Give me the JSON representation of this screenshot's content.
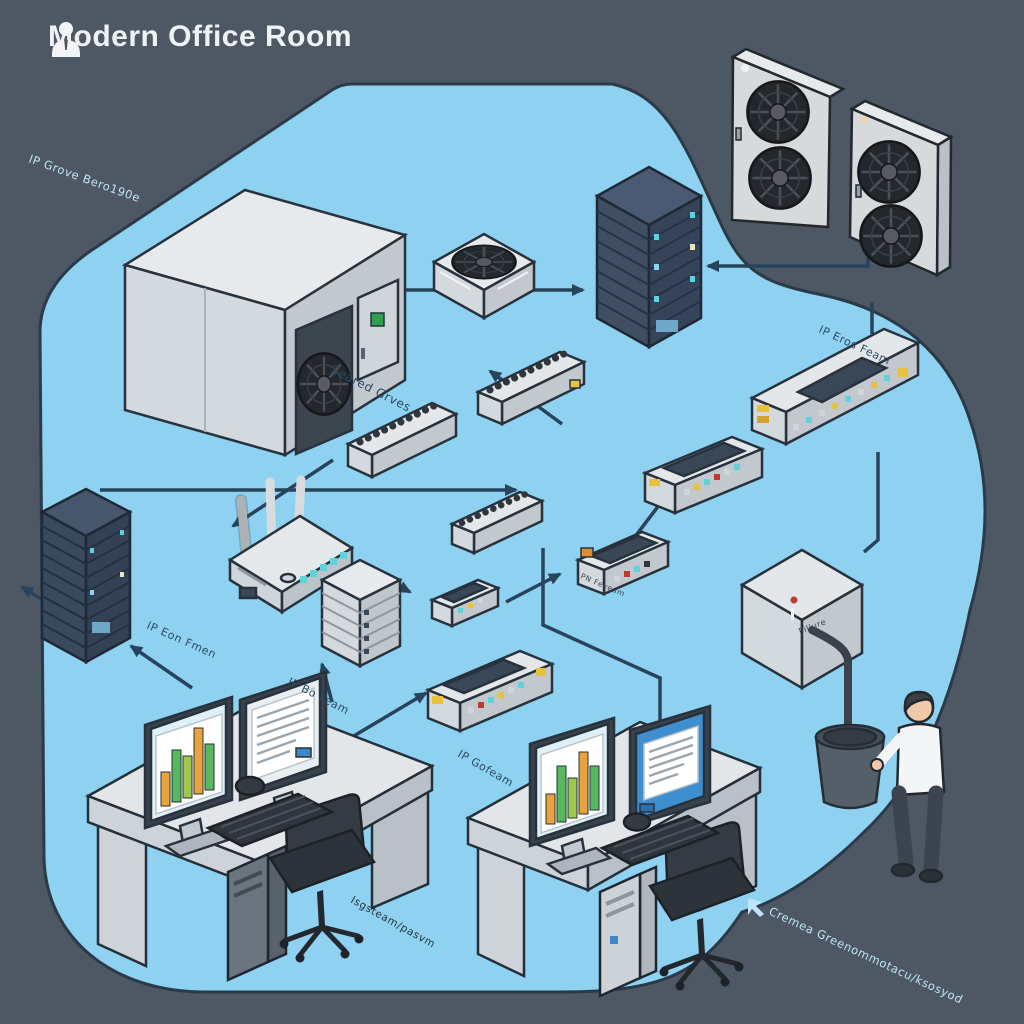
{
  "header": {
    "title": "Modern Office Room"
  },
  "labels": {
    "top_left": "IP Grove Bero190e",
    "served_groves": "Seared Grves",
    "ip_eros_feam": "IP Eros Feam",
    "ip_eon_fmen": "IP Eon Fmen",
    "ip_bo_feam": "IP Bo Feam",
    "ip_gofeam": "IP Gofeam",
    "isgsteam": "Isgsteam/pasvm",
    "bottom_right": "Cremea Greenommotacu/ksosyod",
    "storage_box": "Pillure",
    "controller": "PN Feveum"
  },
  "colors": {
    "background": "#4d5864",
    "room": "#8ed1f0",
    "connector": "#27445c",
    "device_light": "#e3e7ea",
    "device_shade": "#b9c0c7",
    "rack_dark": "#3f4e63",
    "led_teal": "#5fd3dc",
    "accent_green": "#2e9e4f",
    "accent_orange": "#e8a33d",
    "screen_blue": "#3f8fd0",
    "label_dark": "#2c4a63",
    "label_light": "#bfe4f5",
    "title": "#eef2f5"
  },
  "monitor_charts": {
    "left_desk_bars": [
      34,
      52,
      42,
      66,
      46
    ],
    "right_desk_bars": [
      30,
      56,
      40,
      62,
      44
    ]
  },
  "devices": [
    "cooling-cabinet",
    "ceiling-fan-unit",
    "server-tower-center",
    "hvac-unit-1",
    "hvac-unit-2",
    "rack-switch-right",
    "patch-bar-1",
    "patch-bar-2",
    "patch-bar-3",
    "wifi-router",
    "nas-tower",
    "mini-switch",
    "controller-device",
    "rack-switch-mid",
    "rack-switch-bottom",
    "server-tower-left",
    "storage-box",
    "waste-bin",
    "office-worker",
    "desk-left",
    "desk-right"
  ]
}
